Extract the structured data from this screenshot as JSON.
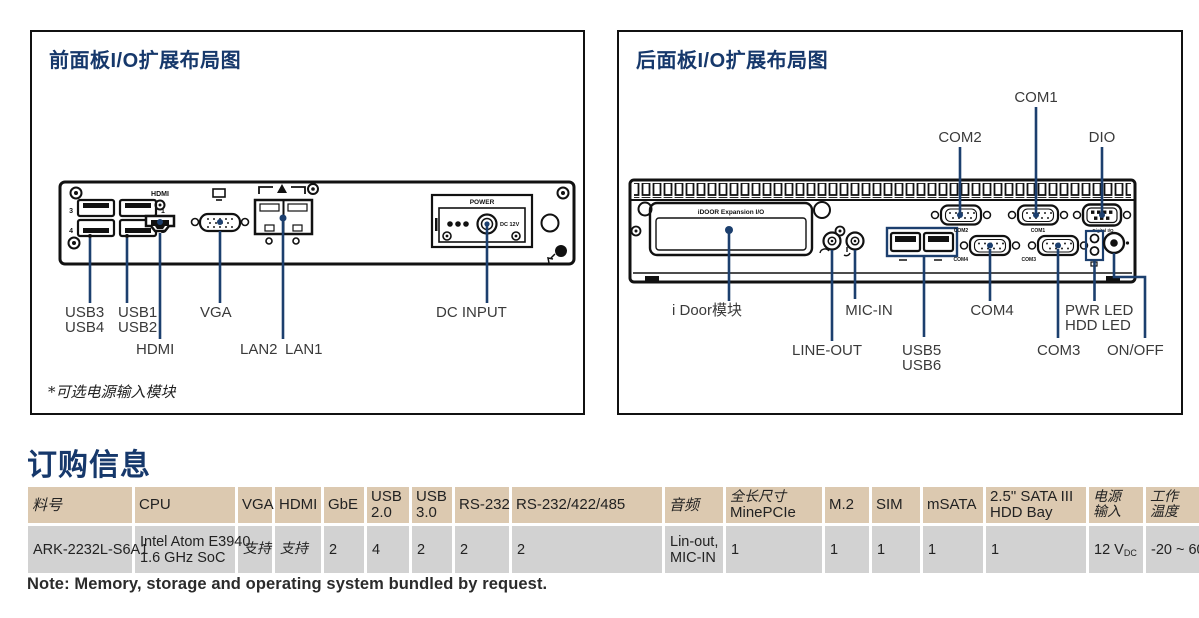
{
  "front_panel": {
    "title": "前面板I/O扩展布局图",
    "footnote": "*可选电源输入模块",
    "port_texts": {
      "hdmi": "HDMI",
      "power": "POWER",
      "dc12v": "DC 12V",
      "usb3_num": "3",
      "usb4_num": "4",
      "usb1_num": "1",
      "usb2_num": "2"
    },
    "labels": {
      "usb3": "USB3",
      "usb4": "USB4",
      "usb1": "USB1",
      "usb2": "USB2",
      "hdmi": "HDMI",
      "vga": "VGA",
      "lan2": "LAN2",
      "lan1": "LAN1",
      "dc_input": "DC INPUT"
    }
  },
  "rear_panel": {
    "title": "后面板I/O扩展布局图",
    "port_texts": {
      "idoor": "iDOOR Expansion I/O",
      "com1": "COM1",
      "com2": "COM2",
      "com3": "COM3",
      "com4": "COM4",
      "dio": "Digital I/O"
    },
    "labels": {
      "com1": "COM1",
      "com2": "COM2",
      "dio": "DIO",
      "idoor": "i Door模块",
      "mic_in": "MIC-IN",
      "com4": "COM4",
      "pwr_led": "PWR LED",
      "hdd_led": "HDD LED",
      "line_out": "LINE-OUT",
      "usb5": "USB5",
      "usb6": "USB6",
      "com3": "COM3",
      "on_off": "ON/OFF"
    }
  },
  "ordering": {
    "heading": "订购信息",
    "note": "Note: Memory, storage and operating system bundled by request.",
    "table": {
      "headers": {
        "part": "料号",
        "cpu": "CPU",
        "vga": "VGA",
        "hdmi": "HDMI",
        "gbe": "GbE",
        "usb20_l1": "USB",
        "usb20_l2": "2.0",
        "usb30_l1": "USB",
        "usb30_l2": "3.0",
        "rs232": "RS-232",
        "rs232_422_485": "RS-232/422/485",
        "audio": "音频",
        "minepcie_l1": "全长尺寸",
        "minepcie_l2": "MinePCIe",
        "m2": "M.2",
        "sim": "SIM",
        "msata": "mSATA",
        "sata_l1": "2.5\" SATA III",
        "sata_l2": "HDD Bay",
        "power_l1": "电源",
        "power_l2": "输入",
        "temp_l1": "工作",
        "temp_l2": "温度"
      },
      "row": {
        "part": "ARK-2232L-S6A1",
        "cpu_l1": "Intel Atom E3940",
        "cpu_l2": "1.6 GHz SoC",
        "vga": "支持",
        "hdmi": "支持",
        "gbe": "2",
        "usb20": "4",
        "usb30": "2",
        "rs232": "2",
        "rs232_422_485": "2",
        "audio_l1": "Lin-out,",
        "audio_l2": "MIC-IN",
        "minepcie": "1",
        "m2": "1",
        "sim": "1",
        "msata": "1",
        "sata": "1",
        "power_main": "12 V",
        "power_sub": "DC",
        "temp": "-20 ~ 60 °C"
      }
    }
  }
}
